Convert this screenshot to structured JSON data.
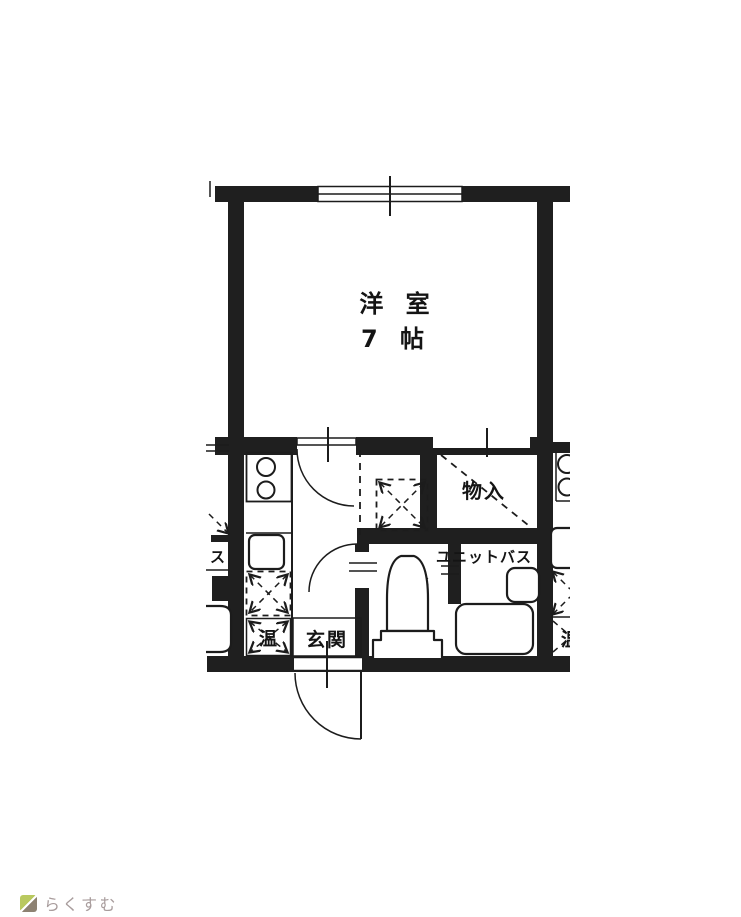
{
  "plan": {
    "main_room": {
      "name": "洋 室",
      "size": "7 帖"
    },
    "storage": {
      "label": "物入"
    },
    "toilet": {
      "label": "便所"
    },
    "unit_bath": {
      "label": "ユニットバス"
    },
    "entrance": {
      "label": "玄関"
    },
    "water_heater": {
      "label": "温"
    },
    "neighbor_left_fragment": {
      "label": "ス"
    },
    "neighbor_right_fragment": {
      "label": "温"
    }
  },
  "watermark": {
    "brand": "らくすむ"
  },
  "colors": {
    "wall": "#1f1f1f",
    "line": "#1c1c1c",
    "ink": "#141414",
    "wm-text": "#a89c9c",
    "wm-roof": "#b9c95f",
    "wm-base": "#8d8272"
  }
}
